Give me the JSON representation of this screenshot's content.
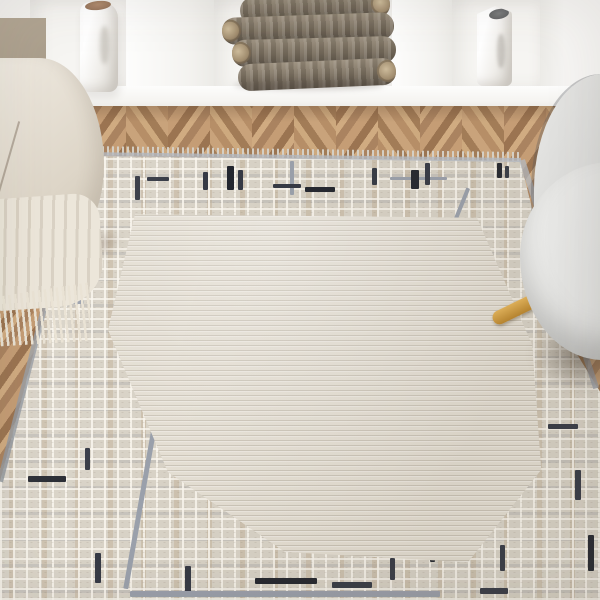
{
  "scene": {
    "description": "Bright living-room product photo of a cream area rug with a geometric maze border, laid on a herringbone wood floor beneath white wall niches",
    "objects": {
      "rug": {
        "name": "cream abstract rug",
        "field_texture": "fine horizontal ridged stripes",
        "border_texture": "embossed maze / circuit grid",
        "field_color": "#e3ddd1",
        "border_base_color": "#d8d2c6",
        "accent_navy": "#353944",
        "accent_gray": "#9aa0ab",
        "accent_tan": "#c0aa89",
        "edge": "short fringe on top end, gray bound sides"
      },
      "floor": {
        "name": "herringbone oak floor",
        "light_tone": "#c9a37b",
        "dark_tone": "#a27c57"
      },
      "wall_unit": {
        "name": "white built-in shelf niches",
        "color": "#f4f3f0",
        "niche_count": 3
      },
      "vase_left": {
        "name": "white ceramic face vase",
        "color": "#ffffff",
        "mouth_interior": "#a5846a"
      },
      "vase_right": {
        "name": "white ceramic face vase",
        "color": "#fbfbfa",
        "mouth_interior": "#6f7071"
      },
      "firewood": {
        "name": "stacked firewood logs",
        "count": 4,
        "bark_color": "#7b7060",
        "end_grain": "#cdbb9b"
      },
      "sofa": {
        "name": "cream sofa arm with taupe cushion",
        "fabric": "#ece6da",
        "throw": "cream fringed throw blanket"
      },
      "armchair": {
        "name": "light gray barrel armchair",
        "fabric": "#d9d9d7",
        "piping": "#4b4e56",
        "leg_wood": "#c8963f"
      }
    }
  }
}
